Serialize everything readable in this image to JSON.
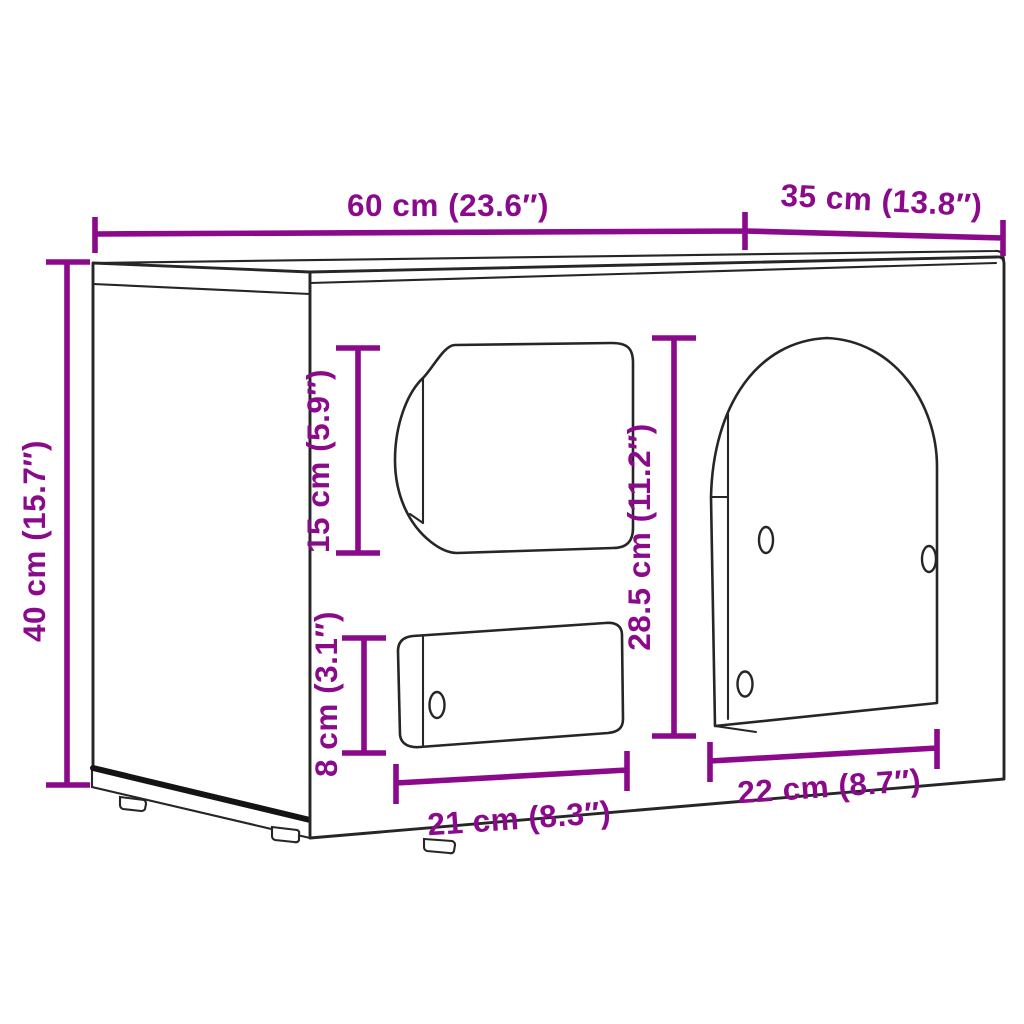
{
  "title": "Cabinet dimension diagram",
  "colors": {
    "dimension_accent": "#8B0A8B",
    "outline": "#262626",
    "background": "#FFFFFF"
  },
  "dimensions": {
    "overall_width": {
      "label": "60 cm (23.6″)"
    },
    "overall_depth": {
      "label": "35 cm (13.8″)"
    },
    "overall_height": {
      "label": "40 cm (15.7″)"
    },
    "entry_opening_height": {
      "label": "15 cm (5.9″)"
    },
    "door_height": {
      "label": "28.5 cm (11.2″)"
    },
    "slot_opening_height": {
      "label": "8 cm (3.1″)"
    },
    "slot_opening_width": {
      "label": "21 cm (8.3″)"
    },
    "door_width": {
      "label": "22 cm (8.7″)"
    }
  }
}
